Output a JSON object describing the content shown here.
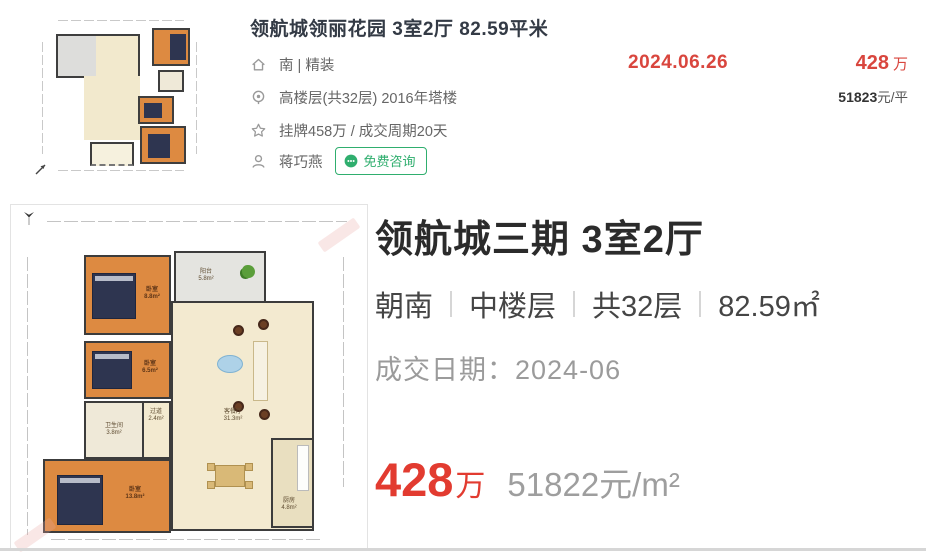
{
  "listing": {
    "title": "领航城领丽花园 3室2厅 82.59平米",
    "rows": [
      {
        "icon": "home-icon",
        "text": "南 | 精装"
      },
      {
        "icon": "location-pin-icon",
        "text": "高楼层(共32层) 2016年塔楼"
      },
      {
        "icon": "star-icon",
        "text": "挂牌458万 / 成交周期20天"
      },
      {
        "icon": "person-icon",
        "text": "蒋巧燕"
      }
    ],
    "deal_date": "2024.06.26",
    "price_value": "428",
    "price_unit": "万",
    "unit_price_value": "51823",
    "unit_price_suffix": "元/平",
    "consult_button": "免费咨询"
  },
  "detail": {
    "title": "领航城三期 3室2厅",
    "attributes": [
      "朝南",
      "中楼层",
      "共32层",
      "82.59㎡"
    ],
    "deal_date_label": "成交日期：",
    "deal_date_value": "2024-06",
    "price_value": "428",
    "price_unit": "万",
    "unit_price": "51822元/m²"
  },
  "floorplan": {
    "rooms": [
      {
        "name": "卧室",
        "area": "8.8m²"
      },
      {
        "name": "阳台",
        "area": "5.8m²"
      },
      {
        "name": "卧室",
        "area": "6.5m²"
      },
      {
        "name": "卫生间",
        "area": "3.8m²"
      },
      {
        "name": "过道",
        "area": "2.4m²"
      },
      {
        "name": "客餐厅",
        "area": "31.3m²"
      },
      {
        "name": "卧室",
        "area": "13.8m²"
      },
      {
        "name": "厨房",
        "area": "4.8m²"
      }
    ]
  },
  "colors": {
    "accent_red": "#d9463e",
    "green": "#2fae6e"
  }
}
